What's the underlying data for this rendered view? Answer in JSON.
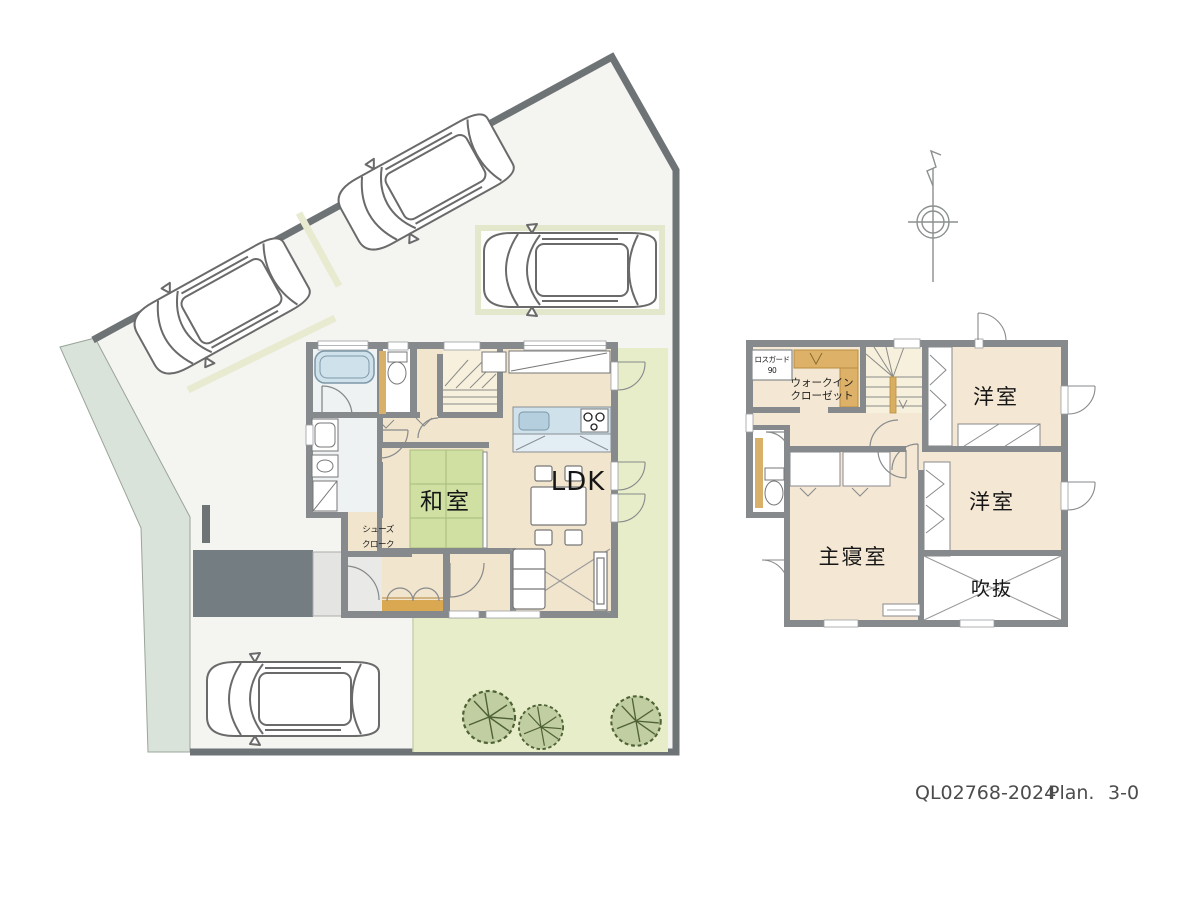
{
  "title_block": {
    "plan_code": "QL02768-2024",
    "plan_label": "Plan.",
    "plan_number": "3-0"
  },
  "first_floor": {
    "ldk": "LDK",
    "japanese_room": "和室",
    "shoe_closet": [
      "シューズ",
      "クローク"
    ]
  },
  "second_floor": {
    "western_room_1": "洋室",
    "western_room_2": "洋室",
    "master_bedroom": "主寝室",
    "void_space": "吹抜",
    "walk_in_closet": [
      "ウォークイン",
      "クローゼット"
    ],
    "ventilation_unit": [
      "ロスガード",
      "90"
    ]
  },
  "colors": {
    "site_boundary": "#6e7376",
    "site_ground": "#f4f4f1",
    "neighbor_green": "#d9e3d9",
    "garden_green": "#e6edc8",
    "approach_gray": "#747d81",
    "wall_gray": "#878a8c",
    "floor_beige_1f": "#f2e5cd",
    "floor_beige_2f": "#f4e7d3",
    "tatami_green": "#cfe0a2",
    "kitchen_blue": "#cfe1ea",
    "genkan_orange": "#d9a850",
    "closet_shelf_orange": "#ddb168",
    "stair_cream": "#f6f0dc"
  }
}
